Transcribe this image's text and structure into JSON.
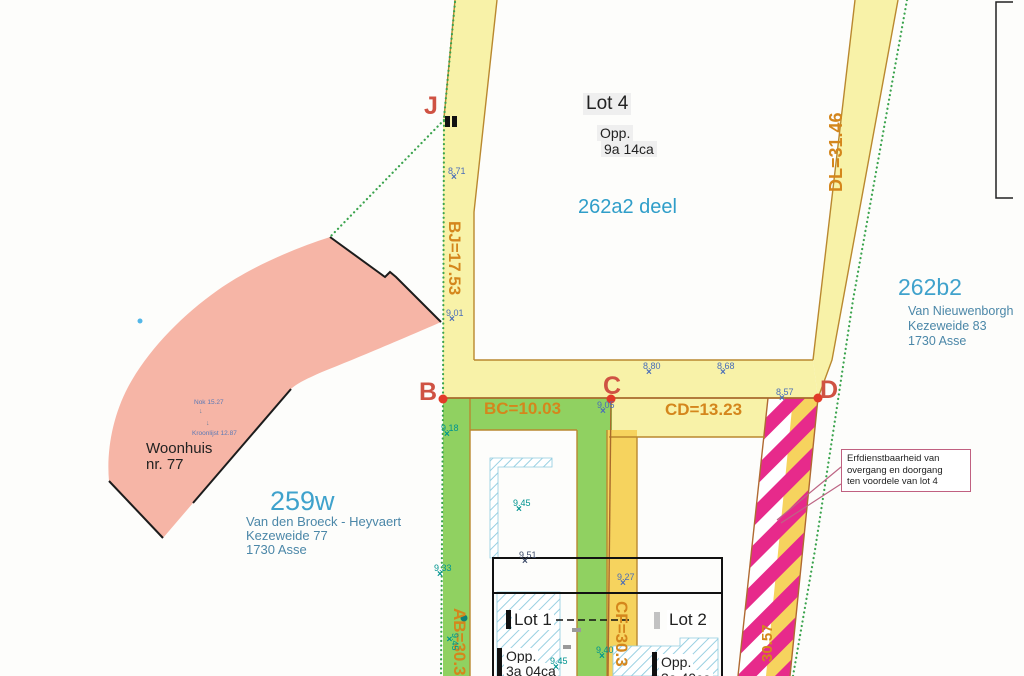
{
  "plan": {
    "points": {
      "j": "J",
      "b": "B",
      "c": "C",
      "d": "D"
    },
    "edge_labels": {
      "bj": "BJ=17.53",
      "bc": "BC=10.03",
      "cd": "CD=13.23",
      "dl": "DL=31.46",
      "ab": "AB=30.3",
      "cf": "CF=30.3",
      "df": "30.57"
    },
    "spot_heights": [
      "8.71",
      "9.01",
      "9.18",
      "9.45",
      "9.51",
      "9.33",
      "9.27",
      "9.40",
      "9.45",
      "8.80",
      "8.68",
      "9.05",
      "8.57",
      "9.45"
    ],
    "lot4": {
      "title": "Lot 4",
      "opp_label": "Opp.",
      "area": "9a 14ca",
      "parcel": "262a2 deel"
    },
    "lot1": {
      "title": "Lot 1",
      "opp_label": "Opp.",
      "area": "3a 04ca"
    },
    "lot2": {
      "title": "Lot 2",
      "opp_label": "Opp.",
      "area": "3a 40ca"
    },
    "parcel_259w": {
      "number": "259w",
      "owner": "Van den Broeck - Heyvaert",
      "street": "Kezeweide 77",
      "city": "1730 Asse"
    },
    "parcel_262b2": {
      "number": "262b2",
      "owner": "Van Nieuwenborgh",
      "street": "Kezeweide 83",
      "city": "1730 Asse"
    },
    "house": {
      "line1": "Woonhuis",
      "line2": "nr. 77",
      "nok": "Nok 15.27",
      "kroonlijst": "Kroonlijst 12.87"
    },
    "callout": {
      "line1": "Erfdienstbaarheid van",
      "line2": "overgang en doorgang",
      "line3": "ten voordele van lot 4"
    },
    "icons": {
      "point_marker": "×",
      "roof_arrow": "↓"
    },
    "colors": {
      "strip_yellow": "#f8f2a8",
      "strip_yellow_deep": "#f6d35e",
      "strip_green": "#90d161",
      "servitude_magenta": "#e72a8b",
      "house_pink": "#f6b5a6",
      "hatch_blue": "#8ecbdf",
      "measure_orange": "#d4861c",
      "point_red": "#cf5243",
      "parcel_blue": "#3fa2cc",
      "boundary_green": "#3aa34d",
      "edge_brown": "#b9882f"
    }
  }
}
